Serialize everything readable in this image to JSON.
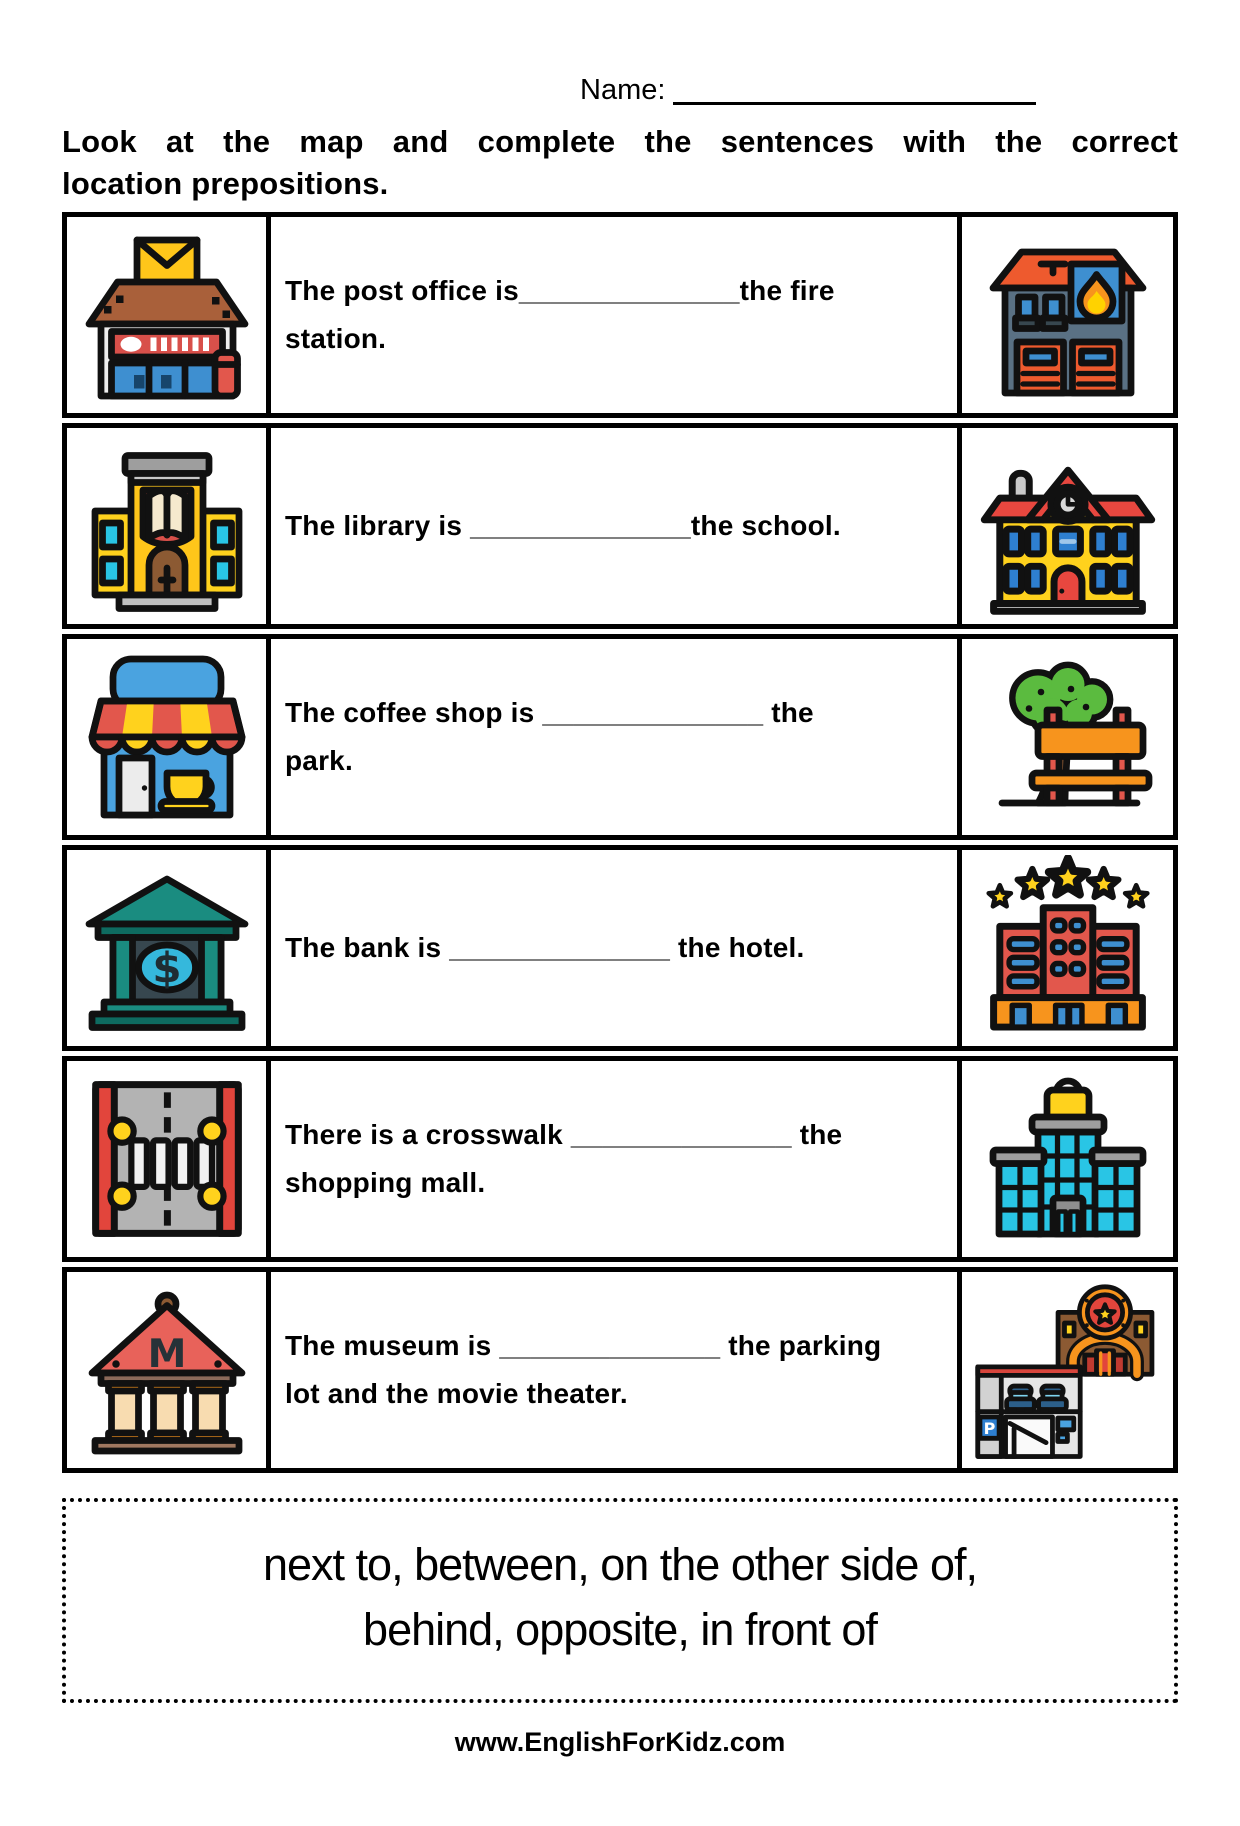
{
  "page": {
    "name_label": "Name:",
    "instructions_line1": "Look at the map and complete the sentences with the correct",
    "instructions_line2": "location prepositions.",
    "footer": "www.EnglishForKidz.com"
  },
  "rows": [
    {
      "left_icon": "post-office",
      "right_icon": "fire-station",
      "text": "The post office is______________the fire station.",
      "lines": [
        "The post office is______________the fire",
        "station."
      ]
    },
    {
      "left_icon": "library",
      "right_icon": "school",
      "text": "The library is ______________the school.",
      "lines": [
        "The library is ______________the school."
      ]
    },
    {
      "left_icon": "coffee-shop",
      "right_icon": "park",
      "text": "The coffee shop is ______________ the park.",
      "lines": [
        "The coffee shop is ______________ the",
        "park."
      ]
    },
    {
      "left_icon": "bank",
      "right_icon": "hotel",
      "text": "The bank is ______________ the hotel.",
      "lines": [
        "The bank is ______________ the hotel."
      ]
    },
    {
      "left_icon": "crosswalk",
      "right_icon": "shopping-mall",
      "text": "There is a crosswalk ______________ the shopping mall.",
      "lines": [
        "There is a crosswalk ______________ the",
        "shopping mall."
      ]
    },
    {
      "left_icon": "museum",
      "right_icon": "parking-lot-and-movie-theater",
      "text": "The museum is ______________ the parking lot and the movie theater.",
      "lines": [
        "The museum is ______________ the parking",
        "lot and the movie theater."
      ]
    }
  ],
  "word_bank": {
    "items": [
      "next to",
      "between",
      "on the other side of",
      "behind",
      "opposite",
      "in front of"
    ],
    "line1": "next to, between, on the other side of,",
    "line2": "behind, opposite, in front of"
  },
  "palette": {
    "outline": "#111111",
    "red": "#E2574C",
    "yellow": "#FFD21D",
    "blue": "#3E8FD0",
    "cyan": "#29C5E5",
    "teal": "#1A8C80",
    "orange": "#F7941D",
    "brown": "#8C5A33",
    "slate": "#5A7184"
  }
}
